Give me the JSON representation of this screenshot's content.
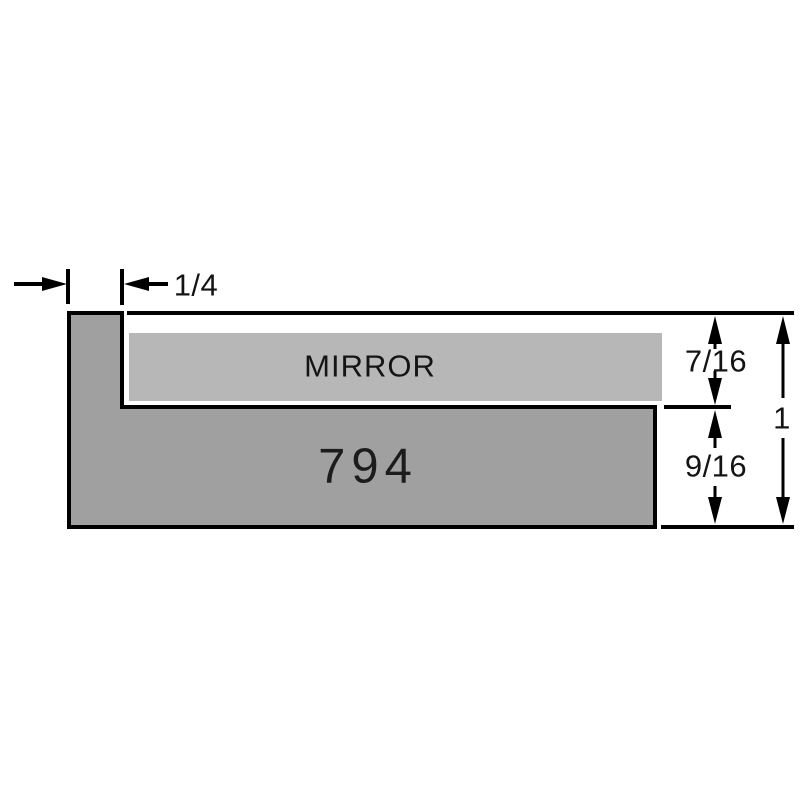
{
  "diagram": {
    "type": "moulding-profile-cross-section",
    "profile_number": "794",
    "mirror_label": "MIRROR",
    "dimensions": {
      "lip_width": "1/4",
      "rabbet_depth": "7/16",
      "lower_height": "9/16",
      "overall_height": "1"
    },
    "colors": {
      "body_fill": "#a0a0a0",
      "mirror_fill": "#b7b7b7",
      "line": "#000000",
      "background": "#ffffff"
    }
  }
}
